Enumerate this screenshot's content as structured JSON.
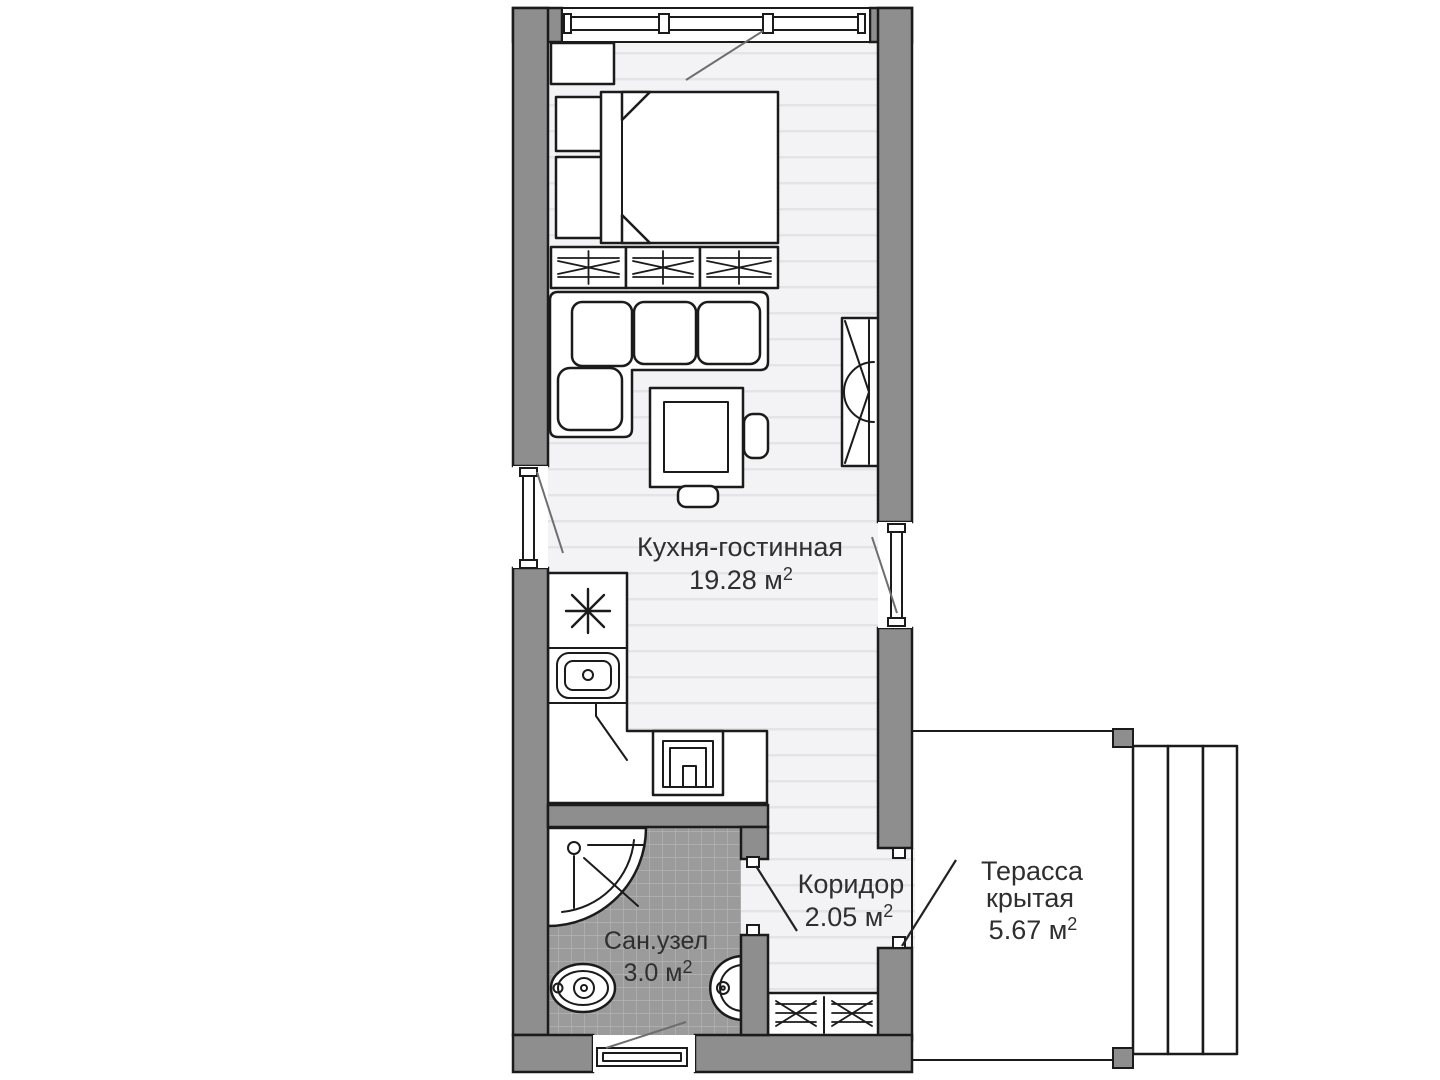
{
  "title": "Студия — план квартиры",
  "labels": {
    "kitchen_living": {
      "name": "Кухня-гостинная",
      "area": "19.28 м",
      "sup": "2"
    },
    "corridor": {
      "name": "Коридор",
      "area": "2.05 м",
      "sup": "2"
    },
    "terrace": {
      "line1": "Терасса",
      "line2": "крытая",
      "area": "5.67 м",
      "sup": "2"
    },
    "bathroom": {
      "name": "Сан.узел",
      "area": "3.0 м",
      "sup": "2"
    }
  },
  "colors": {
    "wall": "#8e8e8e",
    "outline": "#1b1b1b",
    "floor": "#f3f3f5",
    "floor_stripe": "#e4e4e8",
    "terrace": "#e4e4e4",
    "terrace_stripe": "#f6f6f6",
    "tile": "#9b9b9b",
    "tile_line": "#b4b4b4",
    "fixture_fill": "#ffffff",
    "swing": "#6e6e6e",
    "door": "#222222",
    "text": "#2f2f2f"
  }
}
